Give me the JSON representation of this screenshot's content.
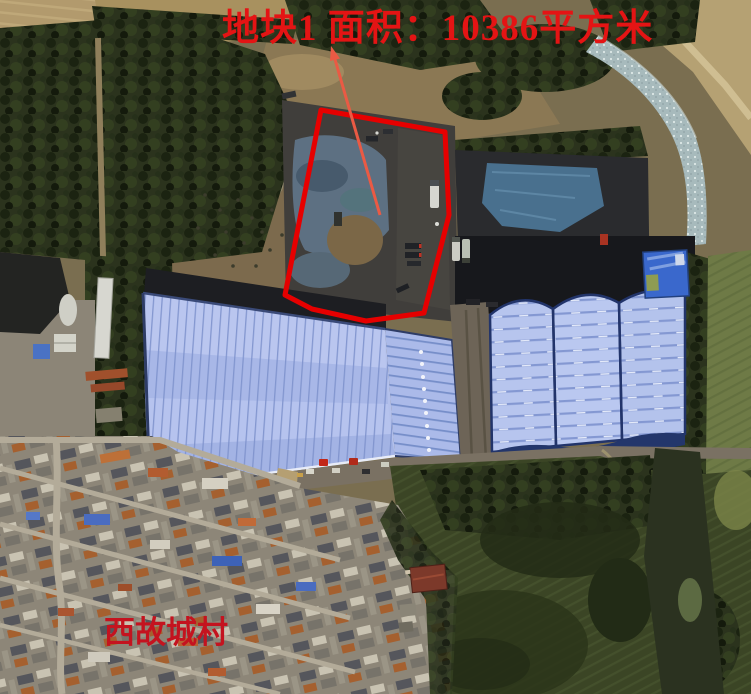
{
  "annotations": {
    "plot_area_label": "地块1 面积：10386平方米",
    "plot_name": "地块1",
    "plot_area_value_sqm": 10386,
    "village_label": "西故城村",
    "label_color": "#e41414",
    "village_label_color": "#c4131f",
    "outline_color": "#e60000",
    "leader_line_color": "#ea5a44"
  },
  "scene_colors": {
    "warehouse_roof": "#b3c0eb",
    "warehouse_stripe": "#7b90cd",
    "coal_dark": "#17181c",
    "tarp_blue": "#49708e",
    "shed_blue": "#3a68cc",
    "field_green": "#3b4525",
    "village_ground": "#8d8678",
    "river_water": "#a7babc",
    "farmland_tan": "#b29a6d",
    "forest_green": "#2b331d",
    "dirt_brown": "#7c6a4d"
  }
}
